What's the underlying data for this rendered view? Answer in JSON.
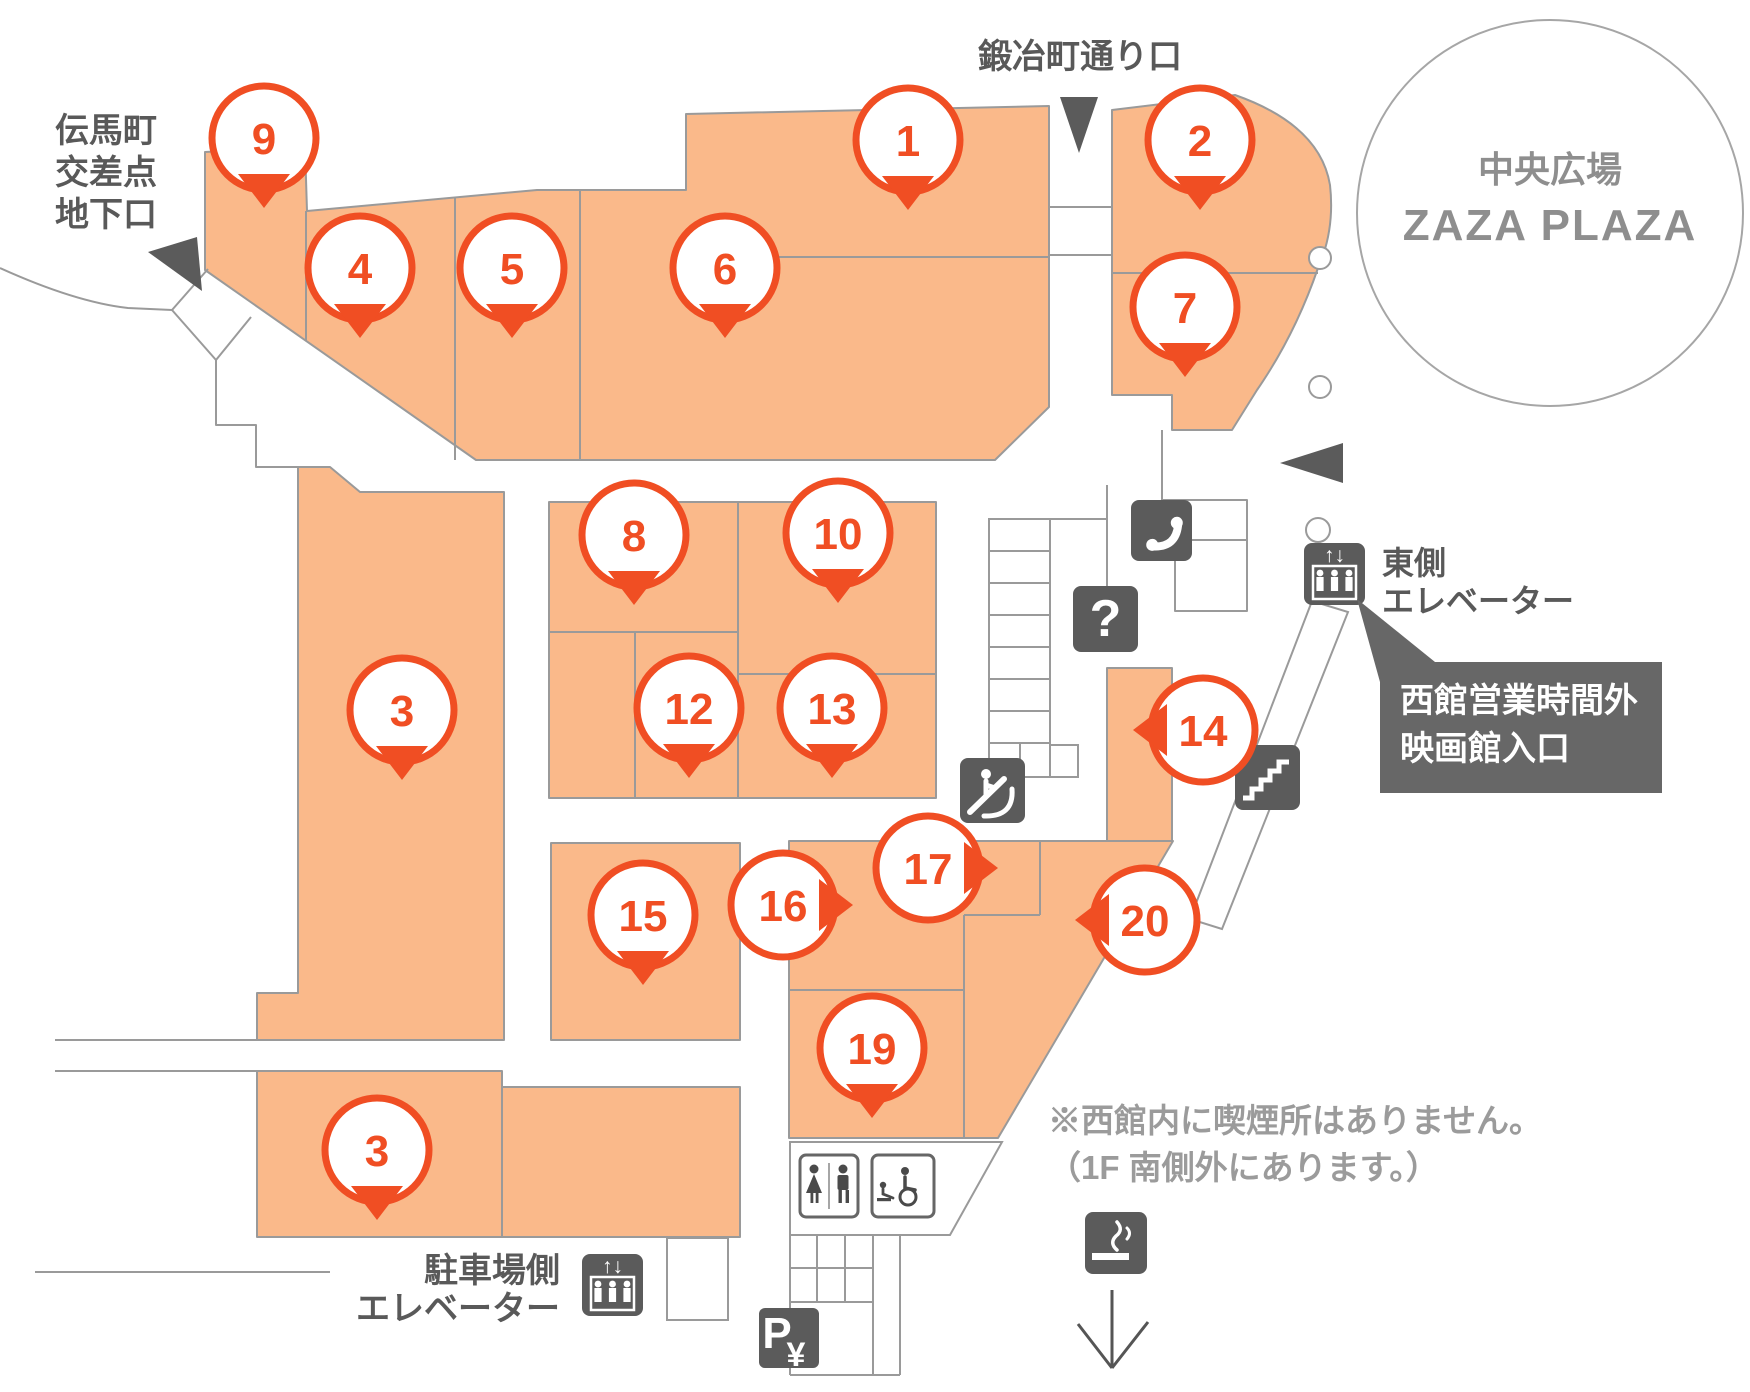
{
  "map": {
    "colors": {
      "shop_fill": "#FAB98A",
      "marker_accent": "#F04E23",
      "outline_gray": "#9A9A9A",
      "icon_dark": "#5B5B5B",
      "label_text": "#595959",
      "note_text": "#9B9B9B"
    },
    "entrances": {
      "west": {
        "lines": [
          "伝馬町",
          "交差点",
          "地下口"
        ]
      },
      "north": {
        "label": "鍛冶町通り口"
      }
    },
    "plaza": {
      "line1": "中央広場",
      "line2": "ZAZA PLAZA"
    },
    "east_elevator": {
      "lines": [
        "東側",
        "エレベーター"
      ]
    },
    "balloon": {
      "lines": [
        "西館営業時間外",
        "映画館入口"
      ]
    },
    "smoking_note": {
      "lines": [
        "※西館内に喫煙所はありません。",
        "（1F 南側外にあります。）"
      ]
    },
    "parking_elevator": {
      "lines": [
        "駐車場側",
        "エレベーター"
      ]
    },
    "parking_pay": {
      "p": "P",
      "yen": "¥"
    },
    "icons": {
      "question": "?",
      "elevator_arrows": "↑↓"
    },
    "markers": [
      {
        "number": "9",
        "x": 264,
        "y": 138,
        "dir": "down"
      },
      {
        "number": "4",
        "x": 360,
        "y": 268,
        "dir": "down"
      },
      {
        "number": "5",
        "x": 512,
        "y": 268,
        "dir": "down"
      },
      {
        "number": "6",
        "x": 725,
        "y": 268,
        "dir": "down"
      },
      {
        "number": "1",
        "x": 908,
        "y": 140,
        "dir": "down"
      },
      {
        "number": "2",
        "x": 1200,
        "y": 140,
        "dir": "down"
      },
      {
        "number": "7",
        "x": 1185,
        "y": 307,
        "dir": "down"
      },
      {
        "number": "8",
        "x": 634,
        "y": 535,
        "dir": "down"
      },
      {
        "number": "10",
        "x": 838,
        "y": 533,
        "dir": "down"
      },
      {
        "number": "12",
        "x": 689,
        "y": 708,
        "dir": "down"
      },
      {
        "number": "13",
        "x": 832,
        "y": 708,
        "dir": "down"
      },
      {
        "number": "3",
        "x": 402,
        "y": 710,
        "dir": "down"
      },
      {
        "number": "14",
        "x": 1203,
        "y": 730,
        "dir": "left"
      },
      {
        "number": "15",
        "x": 643,
        "y": 915,
        "dir": "down"
      },
      {
        "number": "16",
        "x": 783,
        "y": 905,
        "dir": "right"
      },
      {
        "number": "17",
        "x": 928,
        "y": 868,
        "dir": "right"
      },
      {
        "number": "19",
        "x": 872,
        "y": 1048,
        "dir": "down"
      },
      {
        "number": "20",
        "x": 1145,
        "y": 920,
        "dir": "left"
      },
      {
        "number": "3",
        "x": 377,
        "y": 1150,
        "dir": "down"
      }
    ]
  }
}
